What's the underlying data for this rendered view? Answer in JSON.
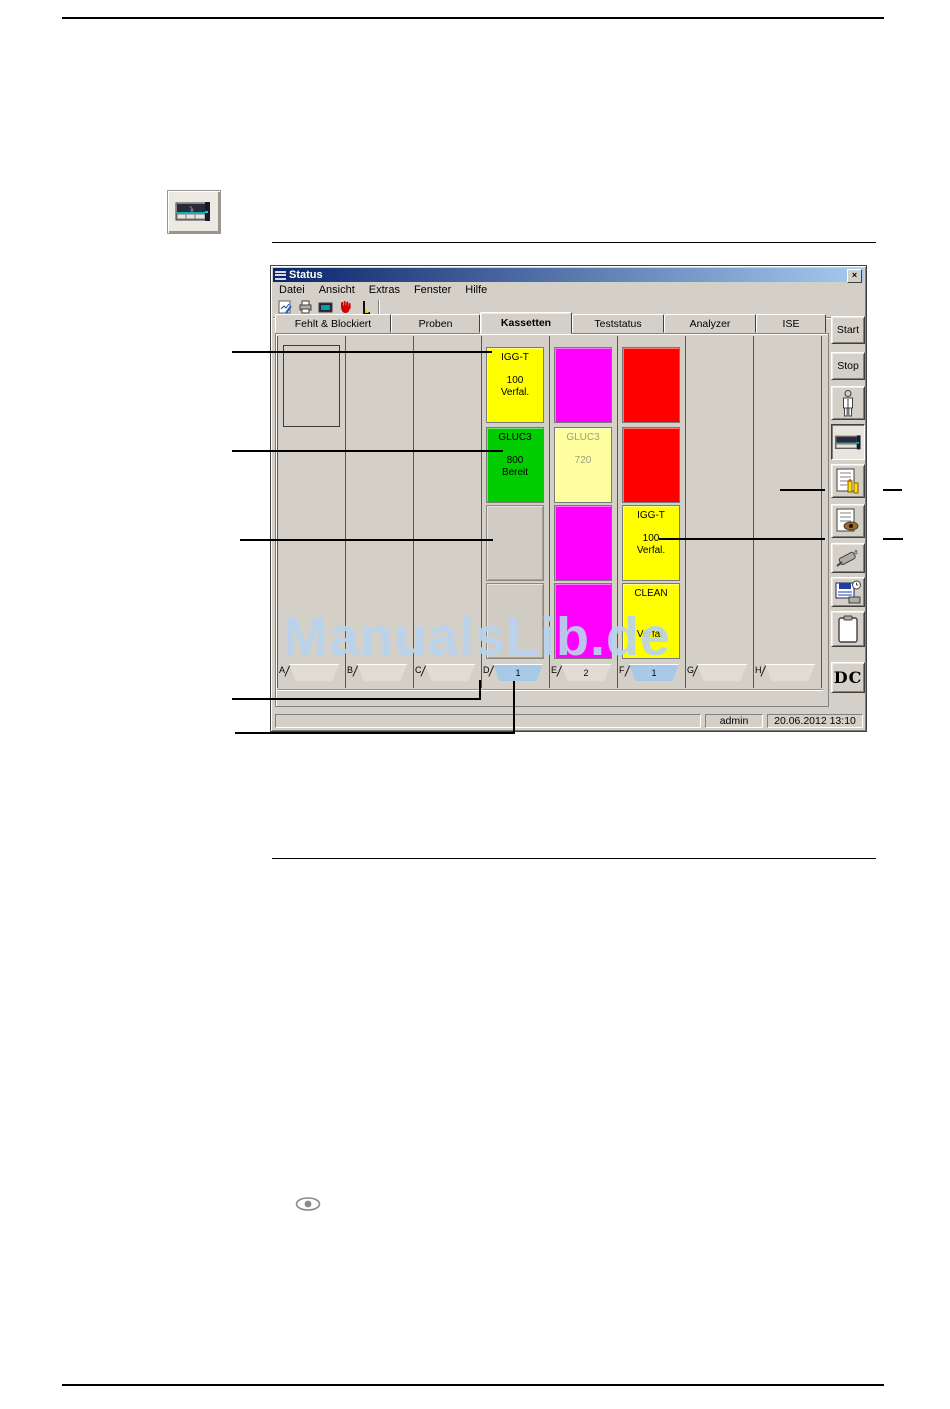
{
  "watermark": "ManualsLib.de",
  "window": {
    "title": "Status",
    "close_glyph": "×",
    "menu": [
      "Datei",
      "Ansicht",
      "Extras",
      "Fenster",
      "Hilfe"
    ],
    "tabs": [
      {
        "label": "Fehlt & Blockiert",
        "active": false
      },
      {
        "label": "Proben",
        "active": false
      },
      {
        "label": "Kassetten",
        "active": true
      },
      {
        "label": "Teststatus",
        "active": false
      },
      {
        "label": "Analyzer",
        "active": false
      },
      {
        "label": "ISE",
        "active": false
      }
    ],
    "rail": {
      "start": "Start",
      "stop": "Stop",
      "dc": "DC"
    },
    "statusbar": {
      "user": "admin",
      "datetime": "20.06.2012 13:10"
    }
  },
  "lanes": [
    {
      "letter": "A",
      "tab_label": "",
      "tab_color": "#e0dcd4"
    },
    {
      "letter": "B",
      "tab_label": "",
      "tab_color": "#e0dcd4"
    },
    {
      "letter": "C",
      "tab_label": "",
      "tab_color": "#e0dcd4"
    },
    {
      "letter": "D",
      "tab_label": "1",
      "tab_color": "#a8c8e8",
      "slots": [
        {
          "color": "#ffff00",
          "name": "IGG-T",
          "count": "100",
          "status": "Verfal."
        },
        {
          "color": "#00cc00",
          "name": "GLUC3",
          "count": "800",
          "status": "Bereit"
        },
        {
          "empty": true
        },
        {
          "empty": true
        }
      ]
    },
    {
      "letter": "E",
      "tab_label": "2",
      "tab_color": "#e0dcd4",
      "slots": [
        {
          "color": "#ff00ff"
        },
        {
          "color": "#ffffa0",
          "text_color": "#9c9c80",
          "name": "GLUC3",
          "count": "720",
          "status": ""
        },
        {
          "color": "#ff00ff"
        },
        {
          "color": "#ff00ff"
        }
      ]
    },
    {
      "letter": "F",
      "tab_label": "1",
      "tab_color": "#a8c8e8",
      "slots": [
        {
          "color": "#ff0000"
        },
        {
          "color": "#ff0000"
        },
        {
          "color": "#ffff00",
          "name": "IGG-T",
          "count": "100",
          "status": "Verfal."
        },
        {
          "color": "#ffff00",
          "name": "CLEAN",
          "count": "",
          "status": "Verfal."
        }
      ]
    },
    {
      "letter": "G",
      "tab_label": "",
      "tab_color": "#e0dcd4"
    },
    {
      "letter": "H",
      "tab_label": "",
      "tab_color": "#e0dcd4"
    }
  ],
  "icons": {
    "title_icon": "menu-lines",
    "toolbar": [
      "chart-edit-icon",
      "printer-icon",
      "monitor-icon",
      "stop-hand-icon",
      "measure-icon"
    ],
    "rail": [
      "operator-icon",
      "cassette-icon",
      "worklist-icon",
      "review-icon",
      "pipette-icon",
      "save-icon",
      "clipboard-icon"
    ],
    "page": [
      "cassette-button-icon",
      "eye-icon"
    ]
  },
  "colors": {
    "chrome": "#d4d0c8",
    "titlebar_left": "#0a246a",
    "titlebar_right": "#a6caf0",
    "status_yellow": "#ffff00",
    "status_green": "#00cc00",
    "status_magenta": "#ff00ff",
    "status_red": "#ff0000",
    "status_pale_yellow": "#ffffa0",
    "drawer_blue": "#a8c8e8",
    "watermark_blue": "#bdd6ee"
  }
}
